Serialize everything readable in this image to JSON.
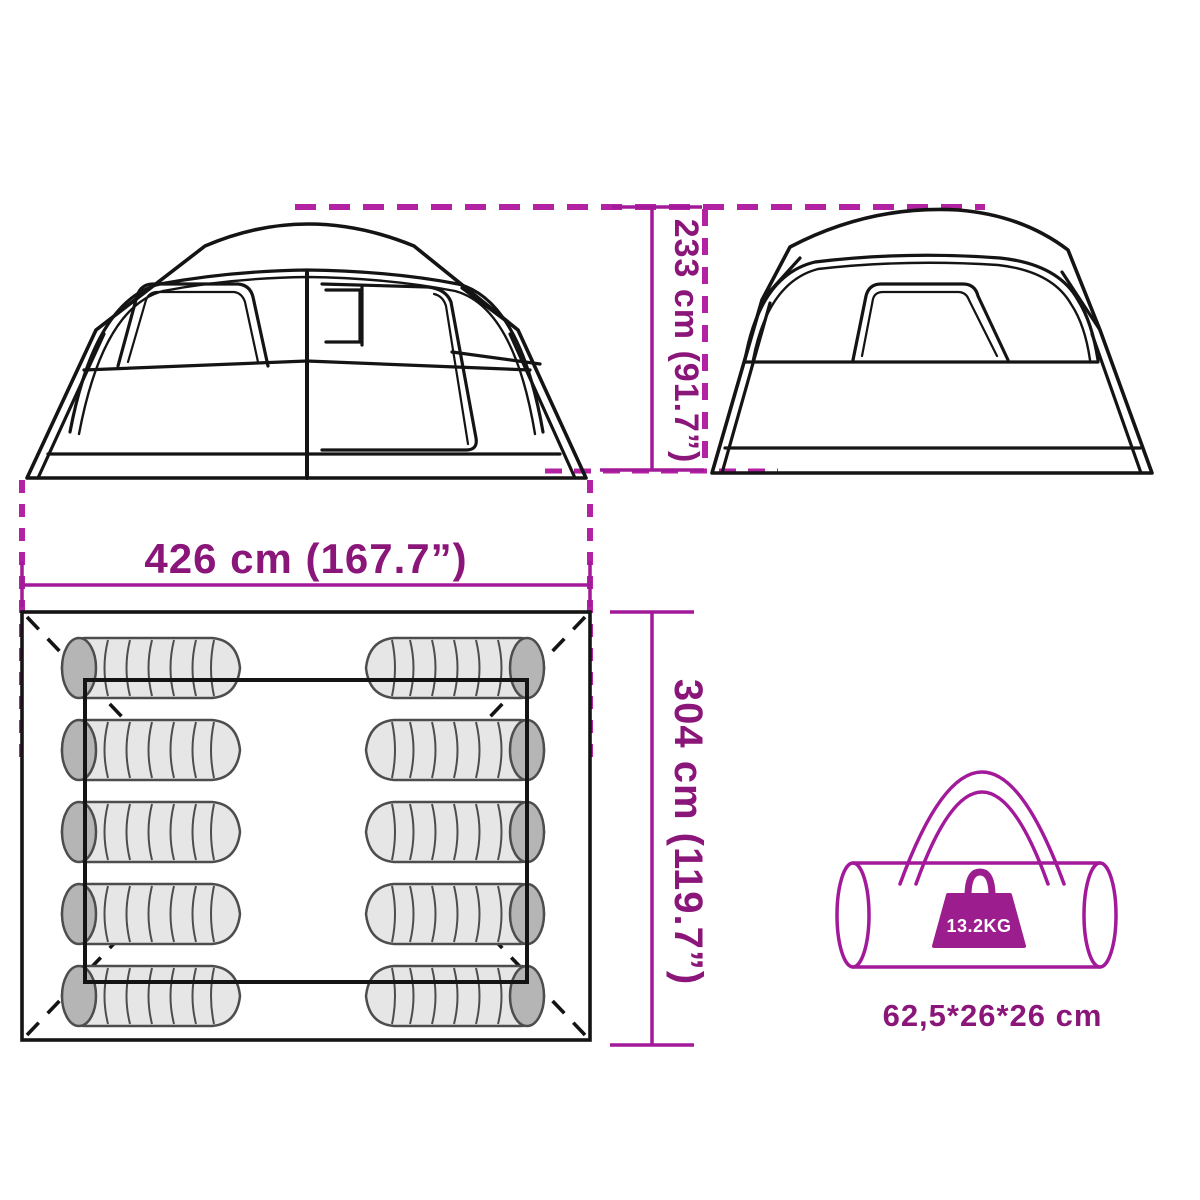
{
  "diagram": {
    "type": "tent-product-dimension-diagram",
    "background": "#ffffff",
    "colors": {
      "dimension_text": "#8b1679",
      "dimension_line": "#a2199a",
      "dashed_guide_line": "#b322a2",
      "drawing_line": "#141414",
      "carry_bag_outline": "#a2199a",
      "weight_badge_fill": "#9c1d8e",
      "weight_badge_text": "#ffffff",
      "sleeping_bag_fill": "#e6e6e6",
      "sleeping_bag_cap": "#b5b5b5"
    },
    "labels": {
      "height": "233 cm (91.7”)",
      "width": "426 cm (167.7”)",
      "depth": "304 cm (119.7”)",
      "weight": "13.2KG",
      "carry_bag_size": "62,5*26*26 cm"
    },
    "floor_plan": {
      "sleeping_bag_count": 10,
      "rows": 5,
      "columns": 2
    }
  }
}
